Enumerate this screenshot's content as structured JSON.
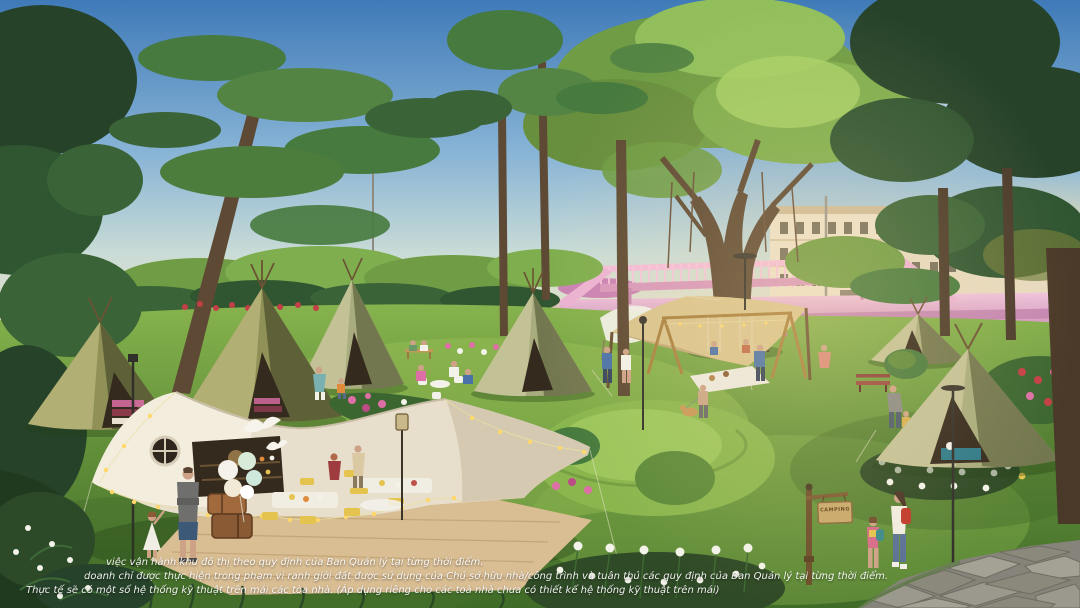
{
  "image": {
    "alt": "Sunlit park rendering with glamping teepee tents on a lawn, a large cream event tent with string lights and balloons, a banyan tree with shade sail and wooden swings, a pink footbridge and cream rowhouses in the background, a flagstone path and a CAMPING sign at right",
    "width_px": 1080,
    "height_px": 608
  },
  "signage": {
    "camping_sign": "CAMPING"
  },
  "disclaimer": {
    "line1": "việc vận hành khu đô thị theo quy định của Ban Quản lý tại từng thời điểm.",
    "line2": "doanh chỉ được thực hiện trong phạm vi ranh giới đất được sử dụng của Chủ sở hữu nhà/công trình và tuân thủ các quy định của Ban Quản lý tại từng thời điểm.",
    "line3": "Thực tế sẽ có một số hệ thống kỹ thuật trên mái các tòa nhà. (Áp dụng riêng cho các toà nhà chưa có thiết kế hệ thống kỹ thuật trên mái)"
  },
  "palette": {
    "sky_top": "#3f7ab8",
    "sky_horizon": "#eee0c2",
    "sun_glow": "#ffe9a8",
    "banyan_green": "#7fae4e",
    "pine_dark": "#26432a",
    "lawn_light": "#84b24c",
    "lawn_dark": "#3f6b28",
    "event_tent_cream": "#e9e0cc",
    "teepee_olive": "#8f9156",
    "teepee_sage": "#a9ac7e",
    "plaza_pink": "#e3aed0",
    "building_cream": "#ece1ca",
    "deck_tan": "#d9bd93",
    "string_light": "#ffd76a",
    "stone_path": "#8b897c"
  }
}
